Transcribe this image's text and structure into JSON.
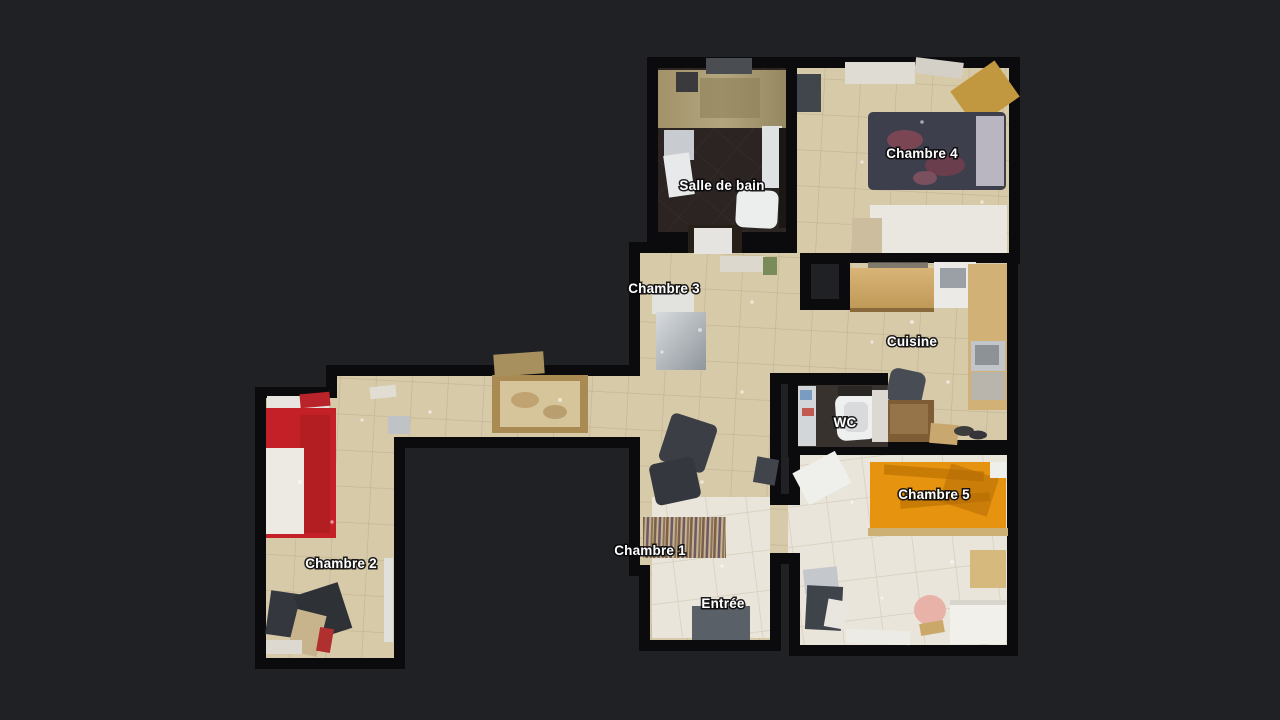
{
  "scene": {
    "background_color": "#1f2125",
    "wall_color": "#0b0b0d",
    "floor_tile_beige": "#d7caa9",
    "floor_tile_light": "#eae5da",
    "floor_dark_marble": "#2b2422",
    "red_bed_color": "#c32127",
    "orange_bed_color": "#e6940f",
    "dark_bed_color": "#3d3f4d",
    "wood_color": "#cfa969",
    "label_text_color": "#ffffff"
  },
  "floorplan": {
    "rooms": [
      {
        "id": "salle-de-bain",
        "label": "Salle de bain"
      },
      {
        "id": "chambre-4",
        "label": "Chambre 4"
      },
      {
        "id": "chambre-3",
        "label": "Chambre 3"
      },
      {
        "id": "cuisine",
        "label": "Cuisine"
      },
      {
        "id": "wc",
        "label": "WC"
      },
      {
        "id": "chambre-5",
        "label": "Chambre 5"
      },
      {
        "id": "chambre-2",
        "label": "Chambre 2"
      },
      {
        "id": "chambre-1",
        "label": "Chambre 1"
      },
      {
        "id": "entree",
        "label": "Entrée"
      }
    ]
  }
}
